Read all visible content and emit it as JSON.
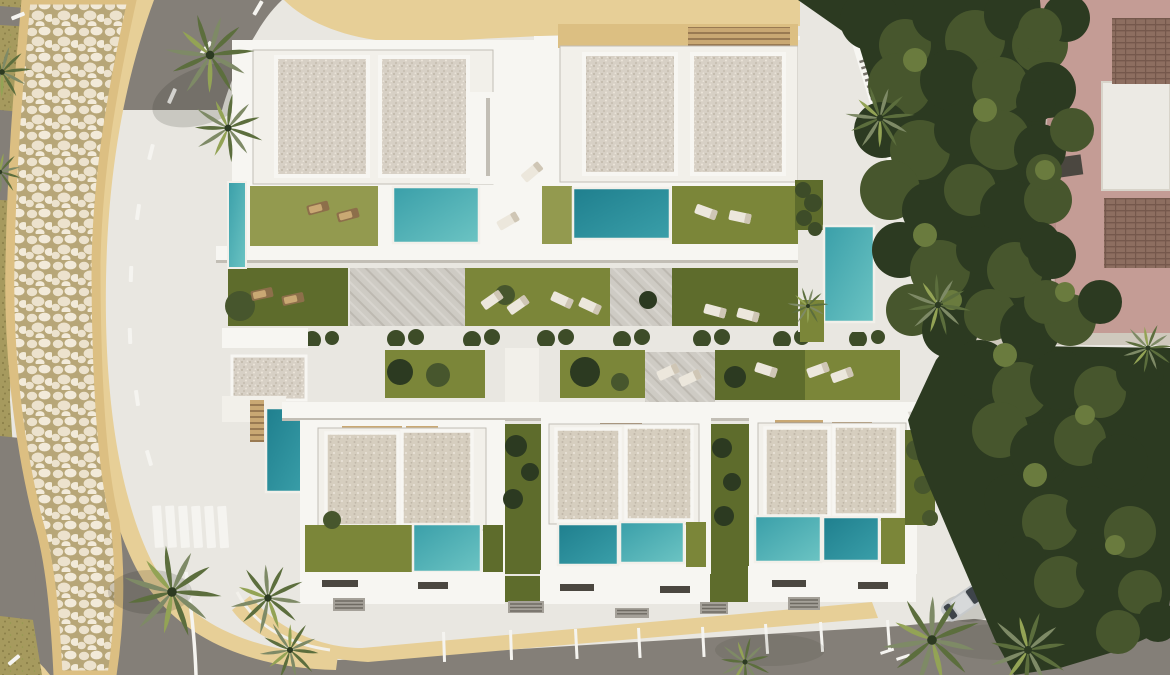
{
  "meta": {
    "title": "Aerial 3D architectural render of a modern villa development",
    "view": "top-down bird's eye",
    "no_visible_text": true
  },
  "scene": {
    "setting": "luxury white villas with private pools, lawns and terraces, bordered by a curved road with a cobblestone footpath on the left, parking bays on the bottom road, and a dense tree mass with a pink neighbouring house on the right",
    "objects": {
      "top_villa_blocks": 2,
      "bottom_villa_blocks": 3,
      "swimming_pools": 10,
      "sun_loungers": 19,
      "palm_trees": 13,
      "parked_cars": 1,
      "crosswalk_stripes": 6,
      "parking_divider_lines": 10,
      "garage_outbuilding": 1,
      "neighbour_building": "pink house with tiled roofs and white roof terrace",
      "footpath": "curved cream cobblestone path with sand verges",
      "roads": [
        "curved asphalt road entering top-left",
        "bottom road with parking bays",
        "road stub exiting bottom-left"
      ]
    }
  },
  "colors": {
    "road": "#847f78",
    "roadd": "#6d6962",
    "platform": "#e9e7e1",
    "wall": "#f7f6f2",
    "wallshade": "#c2beb5",
    "kerb": "#f2f0ea",
    "sand": "#e7cf97",
    "sandd": "#dcbf82",
    "olive": "#a69a5e",
    "olived": "#8b8049",
    "grout": "#b7a678",
    "stone": "#ece2cd",
    "stone2": "#f2ead9",
    "roof": "#d7d0c5",
    "roofdot1": "#c0b7a8",
    "roofdot2": "#ebe5da",
    "roofb": "#d6cebf",
    "pool1": "#6cc4c3",
    "pool2": "#3a9fa9",
    "pool3": "#1f7f8e",
    "lawn": "#7b8639",
    "lawnd": "#5e6c2c",
    "lawnl": "#939a4f",
    "t1": "#2c3a21",
    "t2": "#47562d",
    "t3": "#6a7b3e",
    "hedge": "#3d4c28",
    "palmg": "#7e8a66",
    "palmd": "#5c6e3d",
    "palmb": "#93a355",
    "pink": "#c49c95",
    "pinkd": "#a87e78",
    "tile": "#8d6e60",
    "tileline": "#75584c",
    "pergola": "#c9a873",
    "wood": "#8d6f4a",
    "mark": "#f5f4f0",
    "window": "#4b4740",
    "carbody": "#c6c9cb",
    "carroof": "#d7d9da",
    "glass": "#3e444a",
    "paver": "#cecbc4"
  }
}
